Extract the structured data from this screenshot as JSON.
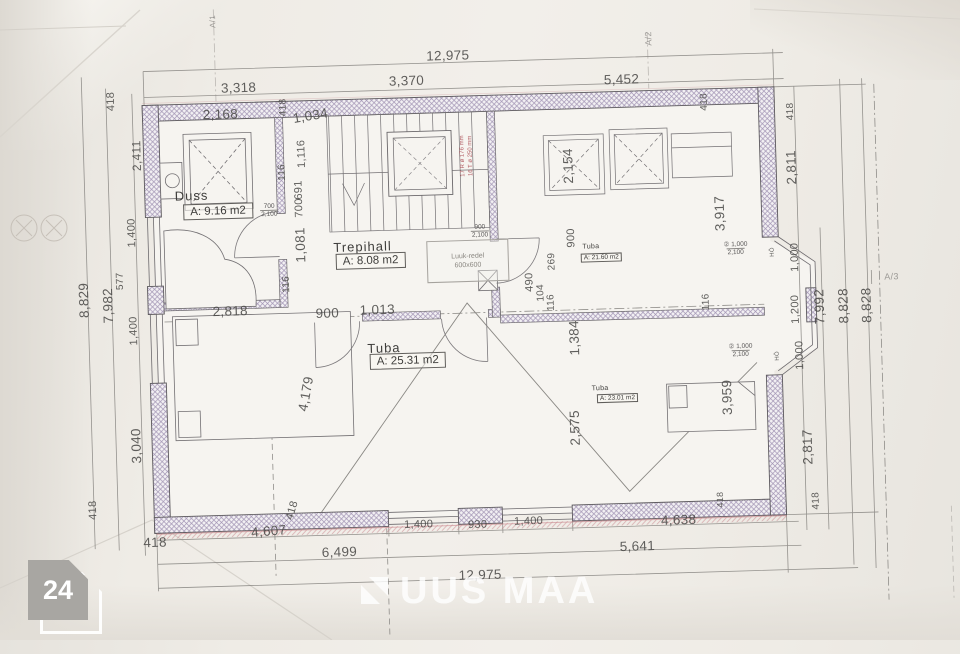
{
  "colors": {
    "paper": "#efece6",
    "wall_hatch": "#a294b4",
    "line": "#7d7b78",
    "red_accent": "#b0444c",
    "watermark_white": "#ffffff",
    "badge_gray": "#a8a6a2"
  },
  "photo_badge": {
    "count": "24"
  },
  "watermark": {
    "brand": "UUS MAA"
  },
  "plan": {
    "luuk": {
      "line1": "Luuk-redel",
      "line2": "600x600"
    },
    "rooms": [
      {
        "name": "Duss",
        "area": "A: 9.16 m2",
        "nx": 178,
        "ny": 180,
        "bx": 186,
        "by": 196,
        "small": false
      },
      {
        "name": "Trepihall",
        "area": "A: 8.08 m2",
        "nx": 335,
        "ny": 236,
        "bx": 337,
        "by": 250,
        "small": false
      },
      {
        "name": "Tuba",
        "area": "A: 21.60 m2",
        "nx": 584,
        "ny": 247,
        "bx": 582,
        "by": 257,
        "small": true
      },
      {
        "name": "Tuba",
        "area": "A: 25.31 m2",
        "nx": 366,
        "ny": 338,
        "bx": 368,
        "by": 351,
        "small": false
      },
      {
        "name": "Tuba",
        "area": "A: 23.01 m2",
        "nx": 589,
        "ny": 389,
        "bx": 594,
        "by": 398,
        "small": true
      }
    ],
    "opening_markers": [
      {
        "top": "700",
        "bottom": "2,100",
        "x": 272,
        "y": 205
      },
      {
        "top": "900",
        "bottom": "2,100",
        "x": 482,
        "y": 232
      },
      {
        "top": "② 1,000",
        "bottom": "2,100",
        "x": 737,
        "y": 257
      },
      {
        "top": "② 1,000",
        "bottom": "2,100",
        "x": 739,
        "y": 359
      }
    ],
    "labels": [
      {
        "t": "12,975",
        "x": 455,
        "y": 55
      },
      {
        "t": "3,318",
        "x": 245,
        "y": 81
      },
      {
        "t": "3,370",
        "x": 413,
        "y": 79
      },
      {
        "t": "5,452",
        "x": 628,
        "y": 84
      },
      {
        "t": "418",
        "x": 117,
        "y": 91,
        "r": -90,
        "s": 11
      },
      {
        "t": "2,411",
        "x": 141,
        "y": 146,
        "r": -90,
        "s": 12
      },
      {
        "t": "418",
        "x": 289,
        "y": 102,
        "r": -90,
        "s": 10
      },
      {
        "t": "418",
        "x": 710,
        "y": 109,
        "r": -90,
        "s": 10
      },
      {
        "t": "418",
        "x": 796,
        "y": 121,
        "r": -90,
        "s": 10
      },
      {
        "t": "2,811",
        "x": 795,
        "y": 177,
        "r": -90
      },
      {
        "t": "3,917",
        "x": 722,
        "y": 221,
        "r": -90
      },
      {
        "t": "1,000",
        "x": 796,
        "y": 267,
        "r": -90,
        "s": 11
      },
      {
        "t": "1,200",
        "x": 795,
        "y": 319,
        "r": -90,
        "s": 11
      },
      {
        "t": "7,992",
        "x": 819,
        "y": 317,
        "r": -90
      },
      {
        "t": "8,828",
        "x": 843,
        "y": 317,
        "r": -90
      },
      {
        "t": "8,828",
        "x": 866,
        "y": 317,
        "r": -90
      },
      {
        "t": "1,000",
        "x": 798,
        "y": 365,
        "r": -90,
        "s": 11
      },
      {
        "t": "2,817",
        "x": 803,
        "y": 457,
        "r": -90
      },
      {
        "t": "418",
        "x": 810,
        "y": 511,
        "r": -90,
        "s": 10
      },
      {
        "t": "8,829",
        "x": 84,
        "y": 289,
        "r": -90
      },
      {
        "t": "7,982",
        "x": 108,
        "y": 295,
        "r": -90
      },
      {
        "t": "577",
        "x": 121,
        "y": 271,
        "r": -90,
        "s": 10
      },
      {
        "t": "1,400",
        "x": 134,
        "y": 223,
        "r": -90,
        "s": 11
      },
      {
        "t": "1,400",
        "x": 133,
        "y": 321,
        "r": -90,
        "s": 11
      },
      {
        "t": "3,040",
        "x": 132,
        "y": 436,
        "r": -90
      },
      {
        "t": "418",
        "x": 87,
        "y": 499,
        "r": -90,
        "s": 11
      },
      {
        "t": "418",
        "x": 148,
        "y": 533
      },
      {
        "t": "4,607",
        "x": 262,
        "y": 525,
        "r": -3
      },
      {
        "t": "418",
        "x": 286,
        "y": 505,
        "r": -72,
        "s": 11
      },
      {
        "t": "1,400",
        "x": 412,
        "y": 523,
        "s": 11
      },
      {
        "t": "930",
        "x": 471,
        "y": 525,
        "s": 11
      },
      {
        "t": "1,400",
        "x": 522,
        "y": 523,
        "s": 11
      },
      {
        "t": "6,499",
        "x": 332,
        "y": 548
      },
      {
        "t": "12,975",
        "x": 472,
        "y": 575
      },
      {
        "t": "4,638",
        "x": 672,
        "y": 526
      },
      {
        "t": "5,641",
        "x": 630,
        "y": 551
      },
      {
        "t": "418",
        "x": 714,
        "y": 507,
        "r": -90,
        "s": 9
      },
      {
        "t": "2,168",
        "x": 226,
        "y": 107
      },
      {
        "t": "1,034",
        "x": 316,
        "y": 111,
        "r": -8
      },
      {
        "t": "1,116",
        "x": 306,
        "y": 149,
        "r": -90,
        "s": 11
      },
      {
        "t": "116",
        "x": 286,
        "y": 167,
        "r": -90,
        "s": 10
      },
      {
        "t": "691",
        "x": 302,
        "y": 185,
        "r": -90,
        "s": 11
      },
      {
        "t": "700",
        "x": 302,
        "y": 203,
        "r": -90,
        "s": 11
      },
      {
        "t": "1,081",
        "x": 302,
        "y": 240,
        "r": -90
      },
      {
        "t": "116",
        "x": 287,
        "y": 279,
        "r": -90,
        "s": 10
      },
      {
        "t": "2,154",
        "x": 572,
        "y": 169,
        "r": -90
      },
      {
        "t": "900",
        "x": 573,
        "y": 241,
        "r": -90,
        "s": 11
      },
      {
        "t": "269",
        "x": 553,
        "y": 264,
        "r": -90,
        "s": 10
      },
      {
        "t": "490",
        "x": 530,
        "y": 284,
        "r": -90,
        "s": 11
      },
      {
        "t": "104",
        "x": 541,
        "y": 295,
        "r": -90,
        "s": 10
      },
      {
        "t": "116",
        "x": 551,
        "y": 305,
        "r": -90,
        "s": 10
      },
      {
        "t": "116",
        "x": 706,
        "y": 309,
        "r": -90,
        "s": 10
      },
      {
        "t": "1,384",
        "x": 573,
        "y": 341,
        "r": -90
      },
      {
        "t": "900",
        "x": 327,
        "y": 309
      },
      {
        "t": "1,013",
        "x": 377,
        "y": 307
      },
      {
        "t": "2,818",
        "x": 230,
        "y": 304
      },
      {
        "t": "4,179",
        "x": 303,
        "y": 389,
        "r": -78
      },
      {
        "t": "2,575",
        "x": 571,
        "y": 431,
        "r": -90
      },
      {
        "t": "3,959",
        "x": 724,
        "y": 405,
        "r": -90
      },
      {
        "t": "A/1",
        "x": 221,
        "y": 14,
        "r": -90,
        "s": 8,
        "c": "faint"
      },
      {
        "t": "A/2",
        "x": 656,
        "y": 44,
        "r": -90,
        "s": 9,
        "c": "faint"
      },
      {
        "t": "A/3",
        "x": 892,
        "y": 289,
        "s": 9,
        "c": "faint"
      },
      {
        "t": "HÖ",
        "x": 774,
        "y": 261,
        "r": -90,
        "s": 6
      },
      {
        "t": "HÖ",
        "x": 776,
        "y": 365,
        "r": -90,
        "s": 6
      },
      {
        "t": "17 R ø 176 mm",
        "x": 467,
        "y": 156,
        "r": -90,
        "s": 6,
        "c": "red"
      },
      {
        "t": "16 T ø 250 mm",
        "x": 475,
        "y": 156,
        "r": -90,
        "s": 6,
        "c": "red"
      }
    ]
  }
}
